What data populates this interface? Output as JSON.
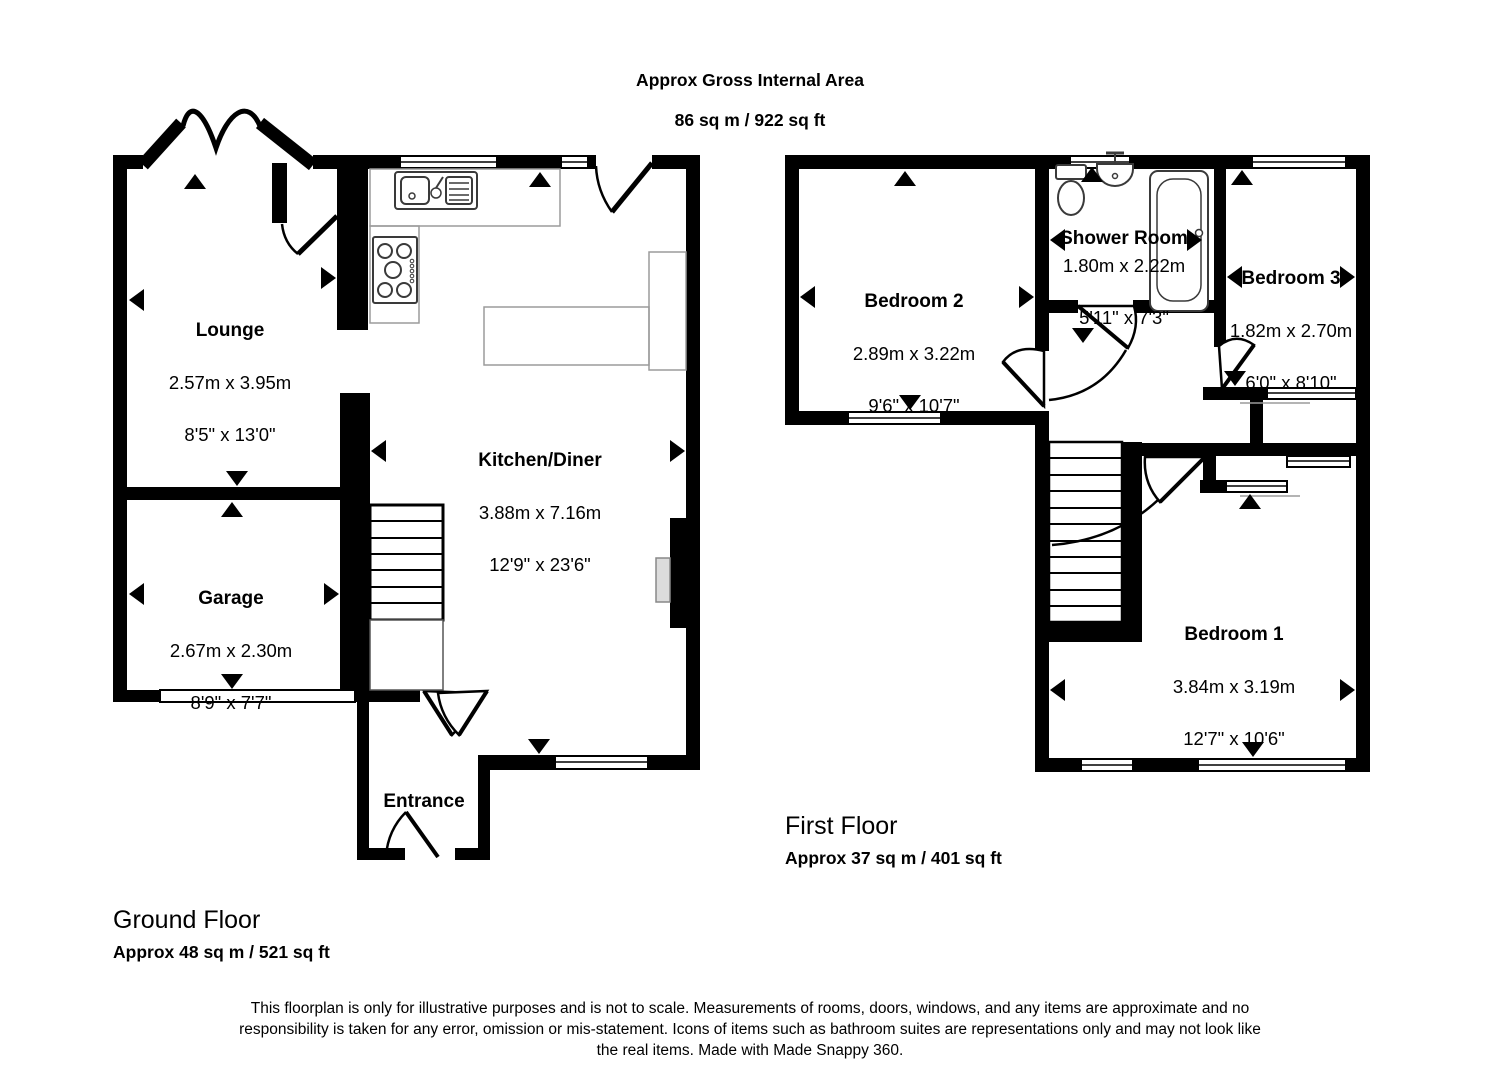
{
  "title": {
    "line1": "Approx Gross Internal Area",
    "line2": "86 sq m / 922 sq ft"
  },
  "ground_floor": {
    "label": "Ground Floor",
    "area": "Approx 48 sq m / 521 sq ft",
    "rooms": {
      "lounge": {
        "name": "Lounge",
        "metric": "2.57m x 3.95m",
        "imperial": "8'5\" x 13'0\""
      },
      "kitchen_diner": {
        "name": "Kitchen/Diner",
        "metric": "3.88m x 7.16m",
        "imperial": "12'9\" x 23'6\""
      },
      "garage": {
        "name": "Garage",
        "metric": "2.67m x 2.30m",
        "imperial": "8'9\" x 7'7\""
      },
      "entrance": {
        "name": "Entrance"
      }
    }
  },
  "first_floor": {
    "label": "First Floor",
    "area": "Approx 37 sq m / 401 sq ft",
    "rooms": {
      "bedroom_2": {
        "name": "Bedroom 2",
        "metric": "2.89m x 3.22m",
        "imperial": "9'6\" x 10'7\""
      },
      "shower_room": {
        "name": "Shower Room",
        "metric": "1.80m x 2.22m",
        "imperial": "5'11\" x 7'3\""
      },
      "bedroom_3": {
        "name": "Bedroom 3",
        "metric": "1.82m x 2.70m",
        "imperial": "6'0\" x 8'10\""
      },
      "bedroom_1": {
        "name": "Bedroom 1",
        "metric": "3.84m x 3.19m",
        "imperial": "12'7\" x 10'6\""
      }
    }
  },
  "disclaimer": "This floorplan is only for illustrative purposes and is not to scale. Measurements of rooms, doors, windows, and any items are approximate and no responsibility is taken for any error, omission or mis-statement. Icons of items such as bathroom suites are representations only and may not look like the real items. Made with Made Snappy 360.",
  "colors": {
    "wall": "#000000",
    "counter_outline": "#9b9b9b",
    "fixture_outline": "#3a3a3a",
    "background": "#ffffff"
  }
}
